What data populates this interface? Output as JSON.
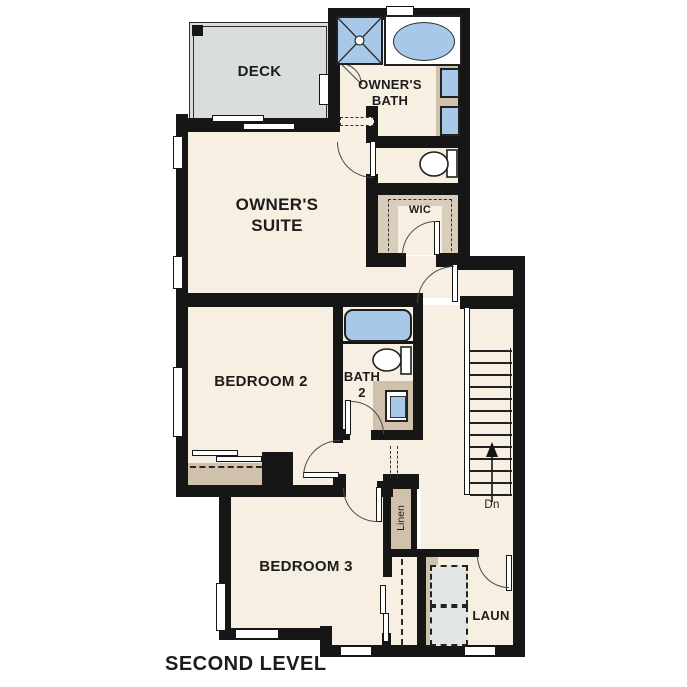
{
  "title": "SECOND LEVEL",
  "rooms": {
    "deck": {
      "label": "DECK"
    },
    "owners_bath": {
      "label": "OWNER'S\nBATH"
    },
    "owners_suite": {
      "label": "OWNER'S\nSUITE"
    },
    "wic": {
      "label": "WIC"
    },
    "bedroom2": {
      "label": "BEDROOM 2"
    },
    "bath2": {
      "label": "BATH\n2"
    },
    "bedroom3": {
      "label": "BEDROOM 3"
    },
    "linen": {
      "label": "Linen"
    },
    "laundry": {
      "label": "LAUN"
    },
    "stairs": {
      "direction_label": "Dn"
    }
  },
  "fixtures": [
    "shower",
    "oval-bathtub",
    "double-vanity-sinks",
    "toilet",
    "bathtub",
    "toilet",
    "vanity-sink",
    "washer",
    "dryer",
    "stairs-down",
    "linen-closet",
    "bedroom2-closet",
    "bedroom3-closet",
    "walk-in-closet"
  ],
  "colors": {
    "floor_cream": "#f6efe2",
    "wall_black": "#161616",
    "deck_gray": "#d9dddc",
    "fixture_blue": "#a8c8e9",
    "counter_tan": "#cfc1ab",
    "appliance_gray": "#e1e5e4",
    "background": "#ffffff"
  }
}
